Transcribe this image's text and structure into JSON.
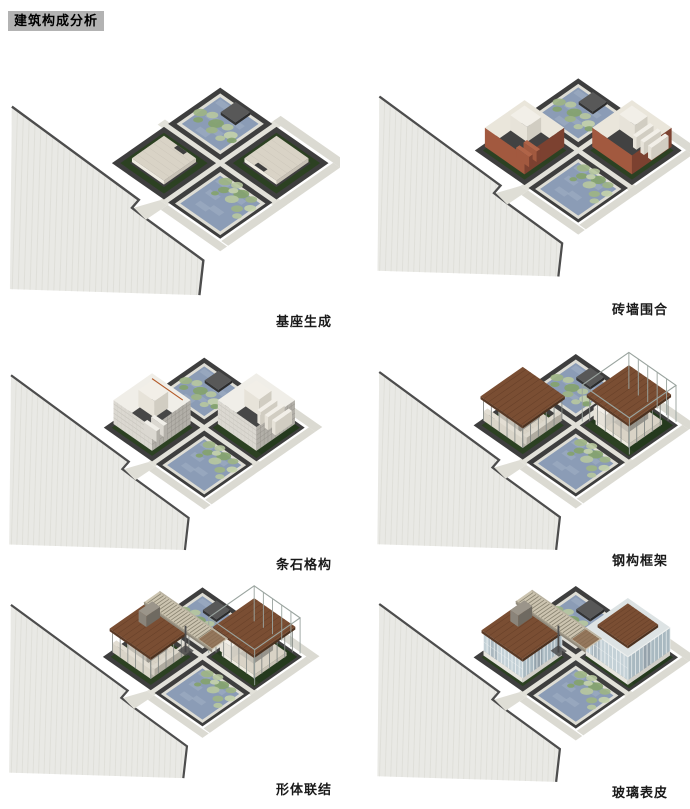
{
  "title": "建筑构成分析",
  "panels": [
    {
      "id": "base",
      "label": "基座生成"
    },
    {
      "id": "brick",
      "label": "砖墙围合"
    },
    {
      "id": "stone",
      "label": "条石格构"
    },
    {
      "id": "steel",
      "label": "钢构框架"
    },
    {
      "id": "link",
      "label": "形体联结"
    },
    {
      "id": "glass",
      "label": "玻璃表皮"
    }
  ],
  "colors": {
    "title_bg": "#b3b3b3",
    "ground": "#e9e9e5",
    "water": "#8b9cb6",
    "lily_green": "#9db584",
    "hedge_green": "#2c4122",
    "dark_plot": "#3e3e3e",
    "brick_wall": "#a2593f",
    "stone_wall": "#dbd8d1",
    "roof_brown": "#7a4e33",
    "glass_skin": "#c4d1d7",
    "dark_green_plot": "#24391d",
    "path": "#e2e1d9"
  }
}
